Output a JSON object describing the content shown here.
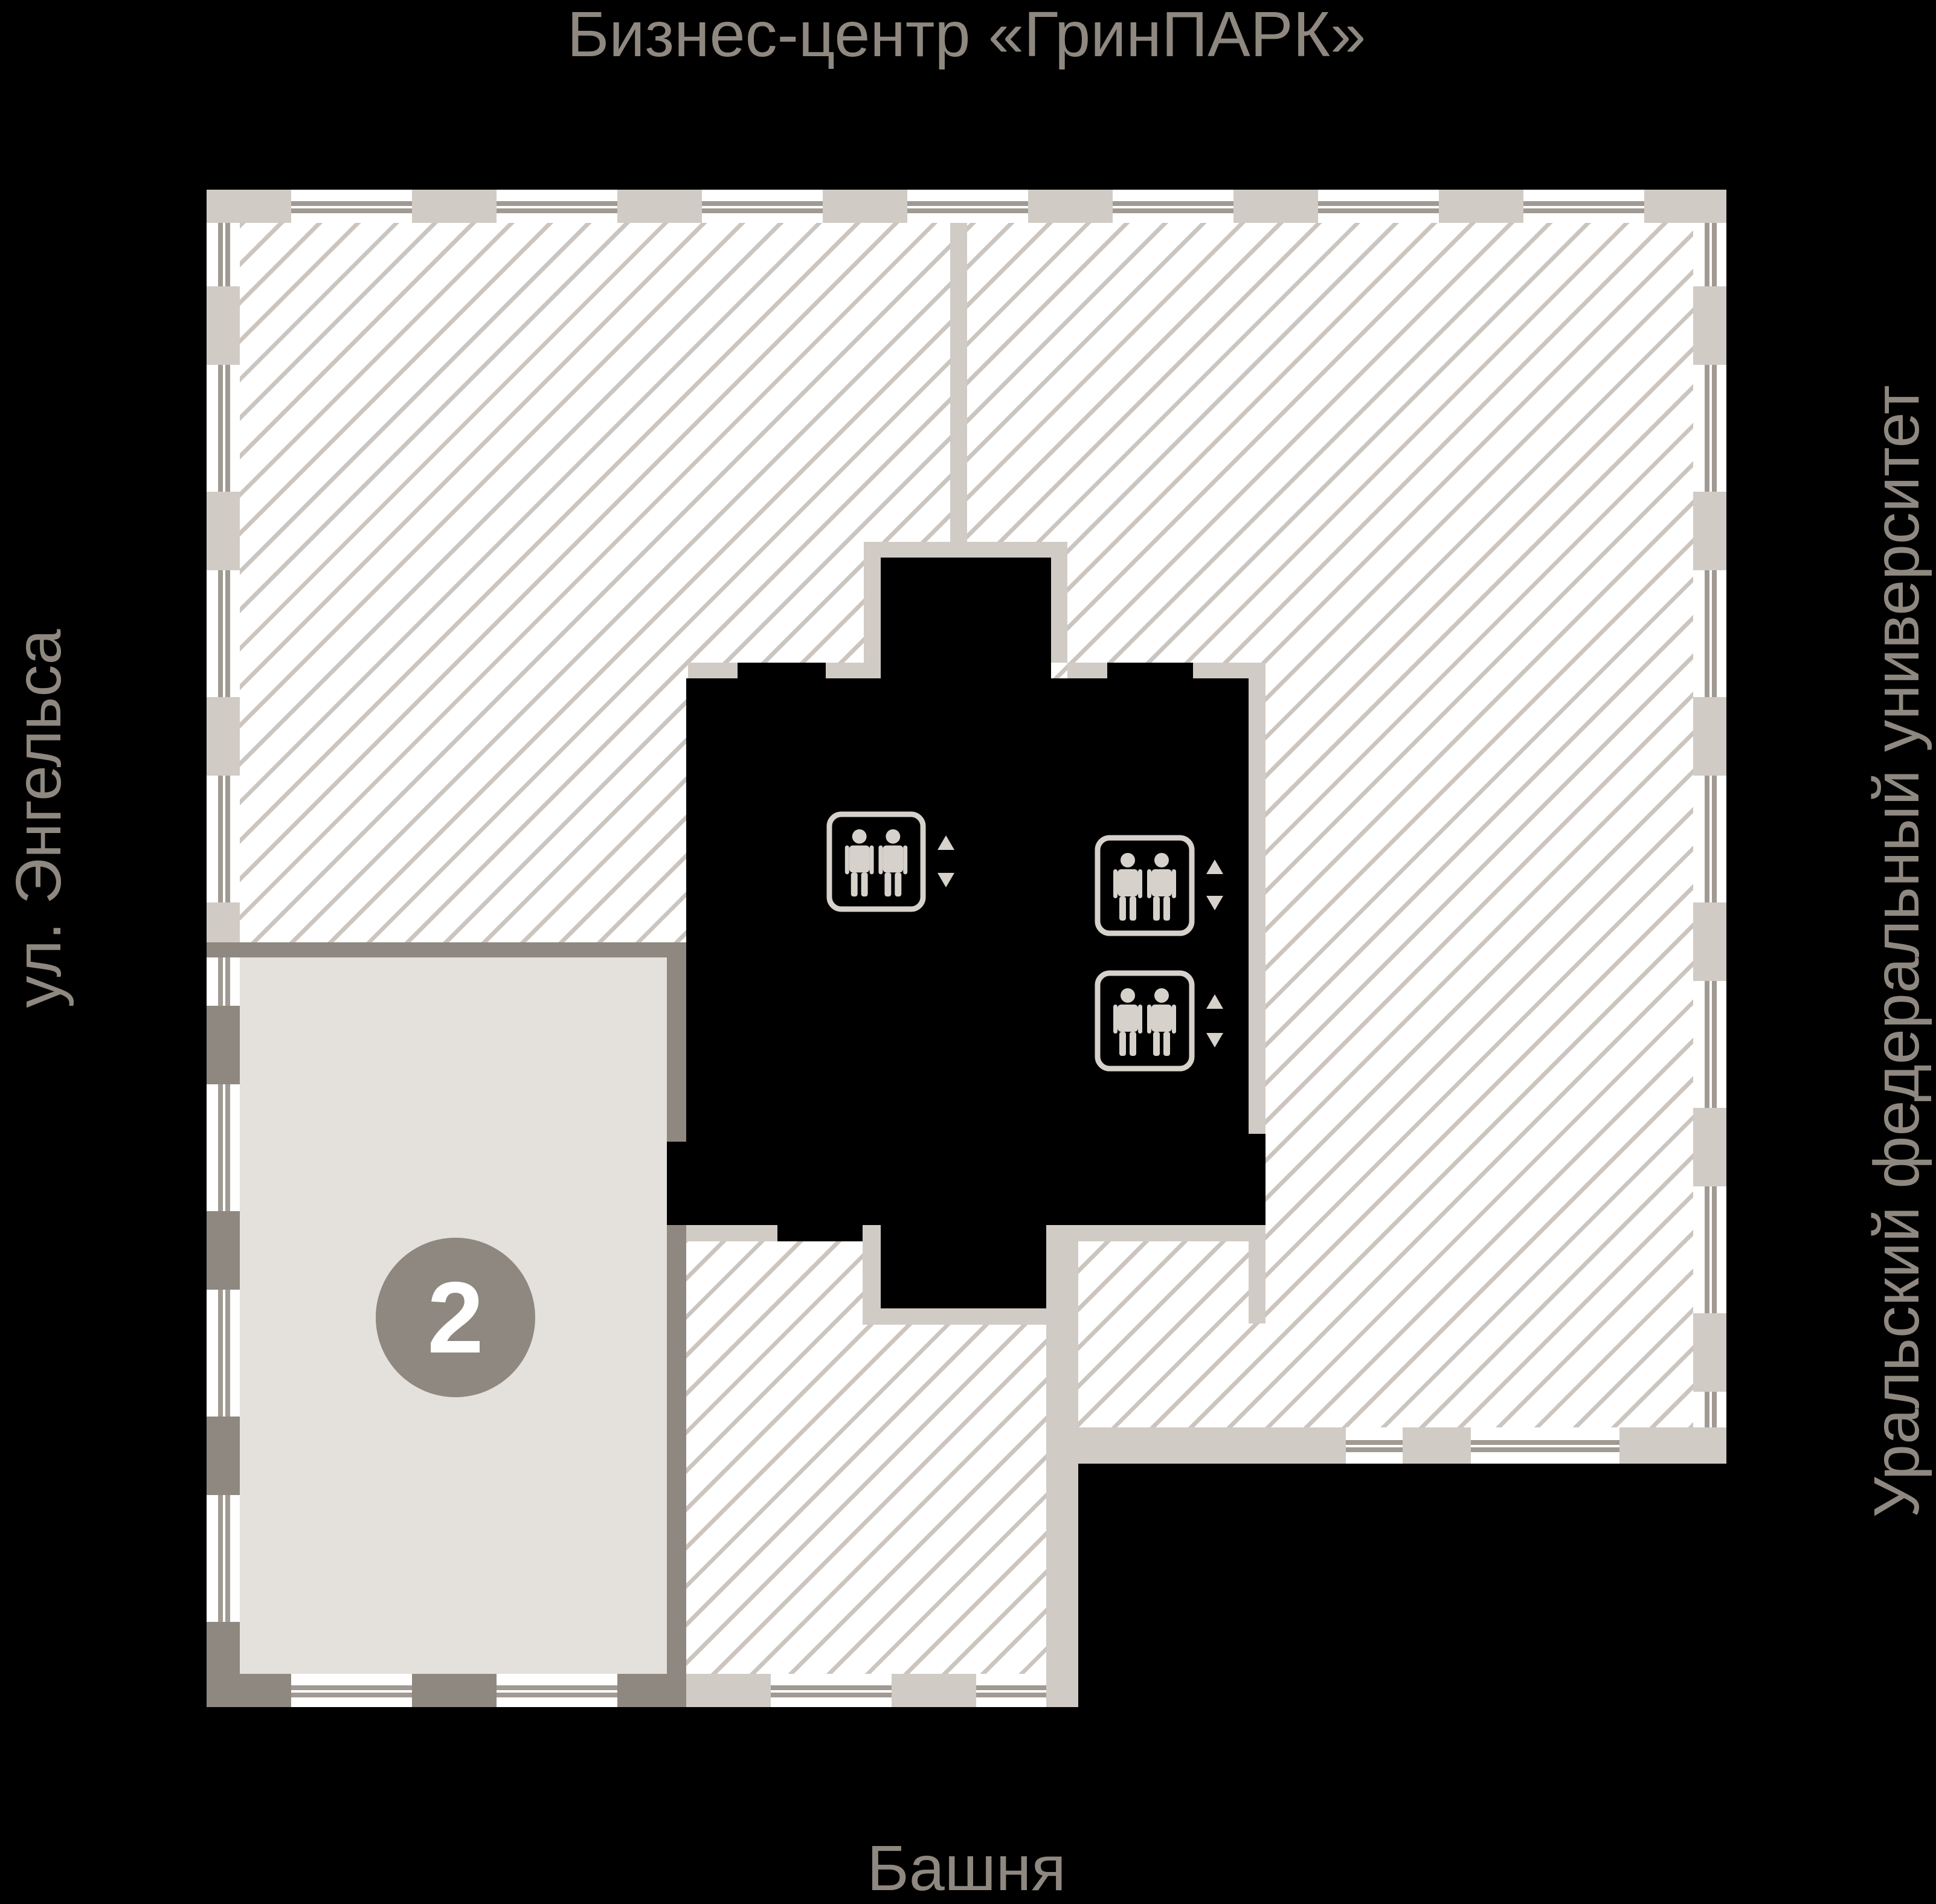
{
  "labels": {
    "top": "Бизнес-центр «ГринПАРК»",
    "left": "ул. Энгельса",
    "right": "Уральский федеральный университет",
    "bottom": "Башня"
  },
  "unit": {
    "number": "2"
  },
  "icons": {
    "elevator": "elevator-icon",
    "arrow_up": "up-arrow-icon",
    "arrow_down": "down-arrow-icon"
  },
  "colors": {
    "black": "#000000",
    "white": "#ffffff",
    "taupe": "#8e8880",
    "wall-light": "#d1cbc5",
    "hatch": "#ccc5bf",
    "unit-fill": "#e4e1dd",
    "icon": "#d6d1cb",
    "glaze": "#a19a93"
  }
}
